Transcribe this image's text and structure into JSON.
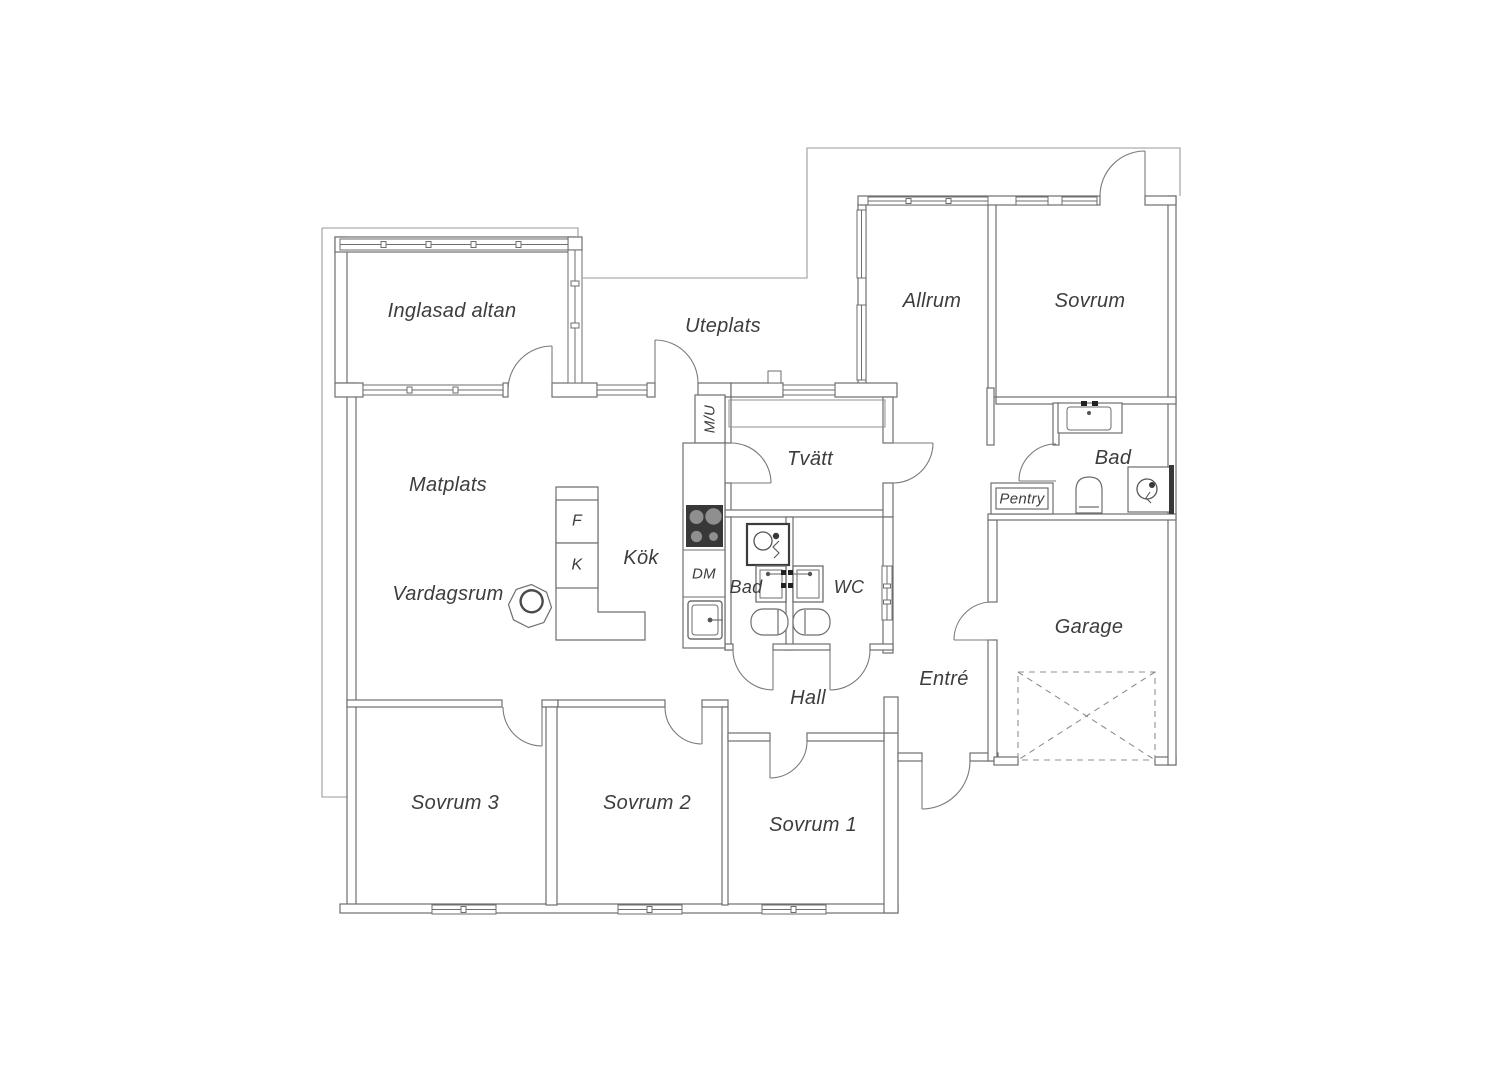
{
  "plan": {
    "type": "floor-plan",
    "language": "Swedish",
    "labels": {
      "inglasad_altan": "Inglasad altan",
      "uteplats": "Uteplats",
      "allrum": "Allrum",
      "sovrum": "Sovrum",
      "matplats": "Matplats",
      "tvatt": "Tvätt",
      "bad_upper": "Bad",
      "pentry": "Pentry",
      "kok": "Kök",
      "vardagsrum": "Vardagsrum",
      "dm": "DM",
      "mu": "M/U",
      "f": "F",
      "k": "K",
      "bad": "Bad",
      "wc": "WC",
      "entre": "Entré",
      "hall": "Hall",
      "garage": "Garage",
      "sovrum_3": "Sovrum 3",
      "sovrum_2": "Sovrum 2",
      "sovrum_1": "Sovrum 1"
    },
    "fixtures": [
      "stove-icon",
      "dishwasher",
      "kitchen-sink-icon",
      "fridge",
      "freezer",
      "shower-icon",
      "washbasin-icon",
      "toilet-icon",
      "fireplace-icon",
      "garage-door-marker",
      "laundry-bench",
      "window",
      "door-swing"
    ],
    "colors": {
      "background": "#ffffff",
      "wall": "#6e6e6e",
      "thin_boundary": "#9a9a9a",
      "text": "#3d3d3d",
      "fixture_dark": "#383838",
      "door_arc": "#7a7a7a"
    }
  }
}
